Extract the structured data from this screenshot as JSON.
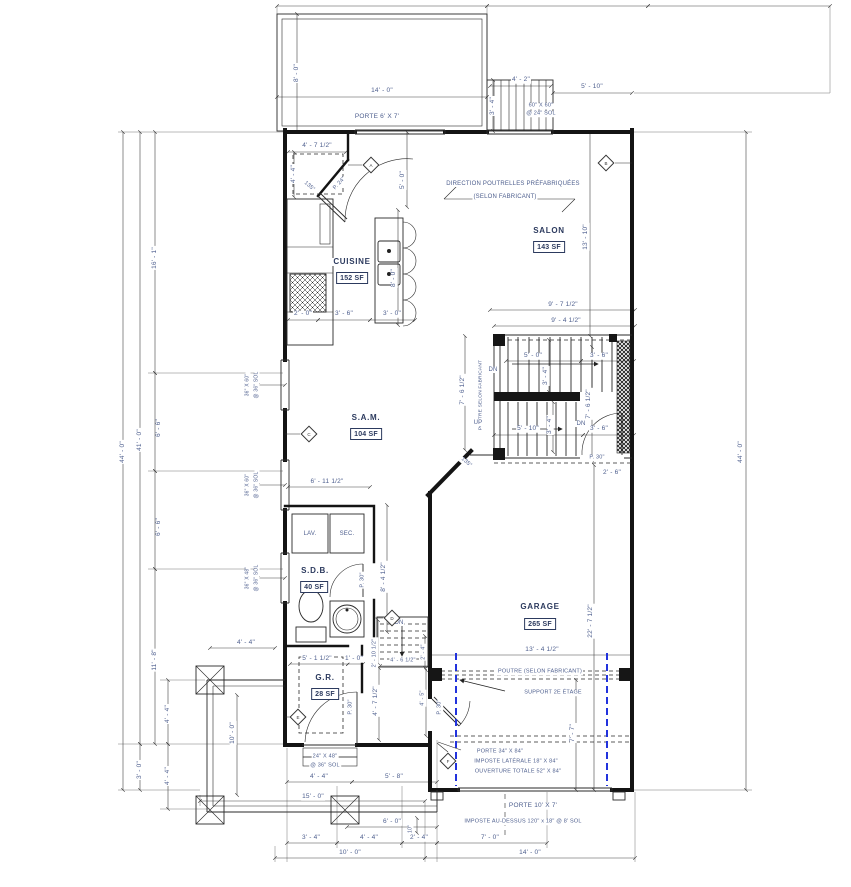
{
  "document": {
    "type": "architectural-floor-plan",
    "units": "imperial"
  },
  "colors": {
    "line": "#141414",
    "dim_text": "#4e5f8e",
    "room_text": "#2c3a5e",
    "support_dash": "#2233dd",
    "paper": "#ffffff"
  },
  "rooms": [
    {
      "name": "CUISINE",
      "area": "152 SF"
    },
    {
      "name": "SALON",
      "area": "143 SF"
    },
    {
      "name": "S.A.M.",
      "area": "104 SF"
    },
    {
      "name": "S.D.B.",
      "area": "40 SF"
    },
    {
      "name": "G.R.",
      "area": "28 SF"
    },
    {
      "name": "GARAGE",
      "area": "265 SF"
    }
  ],
  "markers": [
    {
      "l": "A",
      "x": 371,
      "y": 165
    },
    {
      "l": "B",
      "x": 606,
      "y": 163
    },
    {
      "l": "C",
      "x": 309,
      "y": 434
    },
    {
      "l": "D",
      "x": 392,
      "y": 618
    },
    {
      "l": "E",
      "x": 298,
      "y": 717
    },
    {
      "l": "F",
      "x": 448,
      "y": 761
    }
  ],
  "labels": [
    {
      "n": "dim-deck-height",
      "t": "8' - 0\"",
      "x": 297,
      "y": 73,
      "r": -90
    },
    {
      "n": "dim-deck-width",
      "t": "14' - 0\"",
      "x": 382,
      "y": 91
    },
    {
      "n": "note-porte-deck",
      "t": "PORTE 6' X 7'",
      "x": 377,
      "y": 117
    },
    {
      "n": "dim-ext-stair-width",
      "t": "4' - 2\"",
      "x": 521,
      "y": 80
    },
    {
      "n": "dim-ext-stair-depth",
      "t": "3' - 4\"",
      "x": 493,
      "y": 106,
      "r": -90
    },
    {
      "n": "note-ext-stair-size",
      "t": "60\" X 60\"",
      "x": 541,
      "y": 106,
      "s": 5.5
    },
    {
      "n": "note-ext-stair-sol",
      "t": "@ 24\" SOL",
      "x": 541,
      "y": 114,
      "s": 5.5
    },
    {
      "n": "dim-top-right",
      "t": "5' - 10\"",
      "x": 592,
      "y": 87
    },
    {
      "n": "dim-entry-width",
      "t": "4' - 7 1/2\"",
      "x": 317,
      "y": 146
    },
    {
      "n": "dim-entry-depth",
      "t": "4' - 4\"",
      "x": 294,
      "y": 174,
      "r": -90
    },
    {
      "n": "angle-entry",
      "t": "135°",
      "x": 309,
      "y": 187,
      "r": 40,
      "s": 5.5
    },
    {
      "n": "door-entry",
      "t": "P. 24\"",
      "x": 340,
      "y": 184,
      "r": -47,
      "s": 5.5
    },
    {
      "n": "dim-kitchen-height",
      "t": "5' - 0\"",
      "x": 403,
      "y": 180,
      "r": -90
    },
    {
      "n": "room-cuisine-name",
      "t": "CUISINE",
      "x": 352,
      "y": 262,
      "c": "room"
    },
    {
      "n": "room-cuisine-area",
      "t": "152 SF",
      "x": 352,
      "y": 278,
      "b": true
    },
    {
      "n": "dim-island-height",
      "t": "8' - 0\"",
      "x": 394,
      "y": 278,
      "r": -90
    },
    {
      "n": "dim-kitchen-1",
      "t": "2' - 0\"",
      "x": 303,
      "y": 314
    },
    {
      "n": "dim-kitchen-2",
      "t": "3' - 6\"",
      "x": 344,
      "y": 314
    },
    {
      "n": "dim-kitchen-3",
      "t": "3' - 0\"",
      "x": 392,
      "y": 314
    },
    {
      "n": "note-joists-1",
      "t": "DIRECTION POUTRELLES PRÉFABRIQUÉES",
      "x": 513,
      "y": 184,
      "s": 6
    },
    {
      "n": "note-joists-2",
      "t": "(SELON FABRICANT)",
      "x": 505,
      "y": 197,
      "s": 6
    },
    {
      "n": "room-salon-name",
      "t": "SALON",
      "x": 549,
      "y": 231,
      "c": "room"
    },
    {
      "n": "room-salon-area",
      "t": "143 SF",
      "x": 549,
      "y": 247,
      "b": true
    },
    {
      "n": "dim-salon-height",
      "t": "13' - 10\"",
      "x": 586,
      "y": 237,
      "r": -90
    },
    {
      "n": "dim-stair-top-1",
      "t": "9' - 7 1/2\"",
      "x": 563,
      "y": 305
    },
    {
      "n": "dim-stair-top-2",
      "t": "9' - 4 1/2\"",
      "x": 566,
      "y": 321
    },
    {
      "n": "stair-dn-upper",
      "t": "DN",
      "x": 493,
      "y": 370,
      "s": 6
    },
    {
      "n": "dim-stair-run-1",
      "t": "5' - 0\"",
      "x": 533,
      "y": 356
    },
    {
      "n": "dim-stair-w-1",
      "t": "3' - 4\"",
      "x": 546,
      "y": 376,
      "r": -90
    },
    {
      "n": "dim-stair-land-1",
      "t": "3' - 6\"",
      "x": 599,
      "y": 356
    },
    {
      "n": "dim-stair-h-left",
      "t": "7' - 6 1/2\"",
      "x": 463,
      "y": 390,
      "r": -90
    },
    {
      "n": "note-poutre-stair",
      "t": "POUTRE SELON FABRICANT",
      "x": 482,
      "y": 395,
      "r": -90,
      "s": 4.8
    },
    {
      "n": "dim-stair-h-right",
      "t": "7' - 6 1/2\"",
      "x": 589,
      "y": 404,
      "r": -90
    },
    {
      "n": "stair-up",
      "t": "UP",
      "x": 478,
      "y": 423,
      "s": 6
    },
    {
      "n": "dim-stair-run-2",
      "t": "5' - 10\"",
      "x": 528,
      "y": 429
    },
    {
      "n": "dim-stair-w-2",
      "t": "3' - 4\"",
      "x": 550,
      "y": 425,
      "r": -90
    },
    {
      "n": "stair-dn-lower",
      "t": "DN",
      "x": 581,
      "y": 424,
      "s": 6
    },
    {
      "n": "dim-stair-land-2",
      "t": "3' - 6\"",
      "x": 599,
      "y": 429
    },
    {
      "n": "door-stair-garage",
      "t": "P. 30\"",
      "x": 597,
      "y": 458,
      "s": 5.5
    },
    {
      "n": "dim-below-stair",
      "t": "2' - 6\"",
      "x": 612,
      "y": 473
    },
    {
      "n": "angle-sam-wall",
      "t": "135°",
      "x": 466,
      "y": 463,
      "r": 40,
      "s": 5.5
    },
    {
      "n": "room-sam-name",
      "t": "S.A.M.",
      "x": 366,
      "y": 418,
      "c": "room"
    },
    {
      "n": "room-sam-area",
      "t": "104 SF",
      "x": 366,
      "y": 434,
      "b": true
    },
    {
      "n": "dim-sam-width",
      "t": "6' - 11 1/2\"",
      "x": 327,
      "y": 482
    },
    {
      "n": "win1-size",
      "t": "36\" X 60\"",
      "x": 248,
      "y": 385,
      "r": -90,
      "s": 5
    },
    {
      "n": "win1-sol",
      "t": "@ 36\" SOL",
      "x": 257,
      "y": 385,
      "r": -90,
      "s": 5
    },
    {
      "n": "win2-size",
      "t": "36\" X 60\"",
      "x": 248,
      "y": 485,
      "r": -90,
      "s": 5
    },
    {
      "n": "win2-sol",
      "t": "@ 36\" SOL",
      "x": 257,
      "y": 485,
      "r": -90,
      "s": 5
    },
    {
      "n": "win3-size",
      "t": "36\" X 48\"",
      "x": 248,
      "y": 578,
      "r": -90,
      "s": 5
    },
    {
      "n": "win3-sol",
      "t": "@ 36\" SOL",
      "x": 257,
      "y": 578,
      "r": -90,
      "s": 5
    },
    {
      "n": "dim-win-gap-1",
      "t": "6' - 6\"",
      "x": 159,
      "y": 428,
      "r": -90
    },
    {
      "n": "dim-win-gap-2",
      "t": "6' - 6\"",
      "x": 159,
      "y": 527,
      "r": -90
    },
    {
      "n": "dim-left-16",
      "t": "16' - 1\"",
      "x": 155,
      "y": 258,
      "r": -90
    },
    {
      "n": "dim-left-41",
      "t": "41' - 0\"",
      "x": 140,
      "y": 440,
      "r": -90
    },
    {
      "n": "dim-left-44",
      "t": "44' - 0\"",
      "x": 123,
      "y": 452,
      "r": -90
    },
    {
      "n": "dim-left-11-8",
      "t": "11' - 8\"",
      "x": 155,
      "y": 660,
      "r": -90
    },
    {
      "n": "dim-left-44a",
      "t": "4' - 4\"",
      "x": 168,
      "y": 714,
      "r": -90
    },
    {
      "n": "dim-left-44b",
      "t": "4' - 4\"",
      "x": 168,
      "y": 776,
      "r": -90
    },
    {
      "n": "dim-left-3",
      "t": "3' - 0\"",
      "x": 140,
      "y": 770,
      "r": -90
    },
    {
      "n": "fixture-lav",
      "t": "LAV.",
      "x": 310,
      "y": 534,
      "s": 6
    },
    {
      "n": "fixture-sec",
      "t": "SEC.",
      "x": 347,
      "y": 534,
      "s": 6
    },
    {
      "n": "room-sdb-name",
      "t": "S.D.B.",
      "x": 315,
      "y": 571,
      "c": "room"
    },
    {
      "n": "room-sdb-area",
      "t": "40 SF",
      "x": 314,
      "y": 587,
      "b": true
    },
    {
      "n": "door-sdb",
      "t": "P. 30\"",
      "x": 363,
      "y": 580,
      "r": -90,
      "s": 5.5
    },
    {
      "n": "dim-sdb-height",
      "t": "8' - 4 1/2\"",
      "x": 384,
      "y": 577,
      "r": -90
    },
    {
      "n": "bstair-dn",
      "t": "DN",
      "x": 399,
      "y": 623,
      "s": 6
    },
    {
      "n": "dim-bstair-h",
      "t": "2' - 10 1/2\"",
      "x": 375,
      "y": 653,
      "r": -90,
      "s": 5.5
    },
    {
      "n": "dim-bstair-w",
      "t": "4' - 6 1/2\"",
      "x": 403,
      "y": 661,
      "s": 5.5
    },
    {
      "n": "dim-bstair-h2",
      "t": "2' - 4\"",
      "x": 424,
      "y": 652,
      "r": -90,
      "s": 5.5
    },
    {
      "n": "dim-gr-w1",
      "t": "5' - 1 1/2\"",
      "x": 317,
      "y": 659
    },
    {
      "n": "dim-gr-w2",
      "t": "1' - 0\"",
      "x": 354,
      "y": 659
    },
    {
      "n": "room-gr-name",
      "t": "G.R.",
      "x": 325,
      "y": 678,
      "c": "room"
    },
    {
      "n": "room-gr-area",
      "t": "28 SF",
      "x": 325,
      "y": 694,
      "b": true
    },
    {
      "n": "door-gr",
      "t": "P. 30\"",
      "x": 351,
      "y": 707,
      "r": -90,
      "s": 5.5
    },
    {
      "n": "dim-hall-h1",
      "t": "4' - 7 1/2\"",
      "x": 376,
      "y": 701,
      "r": -90
    },
    {
      "n": "dim-hall-h2",
      "t": "4' - 5\"",
      "x": 423,
      "y": 698,
      "r": -90,
      "s": 5.5
    },
    {
      "n": "door-hall-garage",
      "t": "P. 30\"",
      "x": 440,
      "y": 707,
      "r": -90,
      "s": 5.5
    },
    {
      "n": "room-garage-name",
      "t": "GARAGE",
      "x": 540,
      "y": 607,
      "c": "room"
    },
    {
      "n": "room-garage-area",
      "t": "265 SF",
      "x": 540,
      "y": 624,
      "b": true
    },
    {
      "n": "dim-garage-h",
      "t": "22' - 7 1/2\"",
      "x": 591,
      "y": 621,
      "r": -90
    },
    {
      "n": "dim-garage-w",
      "t": "13' - 4 1/2\"",
      "x": 542,
      "y": 650
    },
    {
      "n": "note-poutre-garage",
      "t": "POUTRE (SELON FABRICANT)",
      "x": 540,
      "y": 672,
      "s": 5.5
    },
    {
      "n": "note-support",
      "t": "SUPPORT 2E ÉTAGE",
      "x": 553,
      "y": 693,
      "s": 5.5
    },
    {
      "n": "note-porte-34",
      "t": "PORTE 34\" X 84\"",
      "x": 500,
      "y": 752,
      "s": 5.5
    },
    {
      "n": "note-imposte-lat",
      "t": "IMPOSTE LATÉRALE 18\" X 84\"",
      "x": 516,
      "y": 762,
      "s": 5.5
    },
    {
      "n": "note-ouverture",
      "t": "OUVERTURE TOTALE 52\" X 84\"",
      "x": 518,
      "y": 772,
      "s": 5.5
    },
    {
      "n": "dim-garage-77",
      "t": "7' - 7\"",
      "x": 573,
      "y": 733,
      "r": -90
    },
    {
      "n": "note-porte-garage",
      "t": "PORTE 10' X 7'",
      "x": 533,
      "y": 806
    },
    {
      "n": "note-imposte-garage",
      "t": "IMPOSTE AU-DESSUS 120\" x 18\" @ 8' SOL",
      "x": 523,
      "y": 822,
      "s": 5.5
    },
    {
      "n": "dim-bot-70",
      "t": "7' - 0\"",
      "x": 490,
      "y": 838
    },
    {
      "n": "dim-bot-140",
      "t": "14' - 0\"",
      "x": 530,
      "y": 853
    },
    {
      "n": "dim-bot-100",
      "t": "10' - 0\"",
      "x": 350,
      "y": 853
    },
    {
      "n": "dim-bot-34",
      "t": "3' - 4\"",
      "x": 311,
      "y": 838
    },
    {
      "n": "dim-bot-44",
      "t": "4' - 4\"",
      "x": 369,
      "y": 838
    },
    {
      "n": "dim-bot-24",
      "t": "2' - 4\"",
      "x": 419,
      "y": 838
    },
    {
      "n": "dim-bot-60",
      "t": "6' - 0\"",
      "x": 392,
      "y": 822
    },
    {
      "n": "dim-bot-10in",
      "t": "10\"",
      "x": 411,
      "y": 829,
      "r": -90,
      "s": 5
    },
    {
      "n": "dim-bot-150",
      "t": "15' - 0\"",
      "x": 313,
      "y": 797
    },
    {
      "n": "win4-size",
      "t": "24\" X 48\"",
      "x": 325,
      "y": 757,
      "s": 5.5
    },
    {
      "n": "win4-sol",
      "t": "@ 36\" SOL",
      "x": 325,
      "y": 766,
      "s": 5.5
    },
    {
      "n": "dim-bw-44",
      "t": "4' - 4\"",
      "x": 319,
      "y": 777
    },
    {
      "n": "dim-bw-58",
      "t": "5' - 8\"",
      "x": 394,
      "y": 777
    },
    {
      "n": "dim-porch-44",
      "t": "4' - 4\"",
      "x": 246,
      "y": 643
    },
    {
      "n": "dim-porch-100",
      "t": "10' - 0\"",
      "x": 233,
      "y": 733,
      "r": -90
    },
    {
      "n": "dim-right-44",
      "t": "44' - 0\"",
      "x": 741,
      "y": 452,
      "r": -90
    }
  ]
}
